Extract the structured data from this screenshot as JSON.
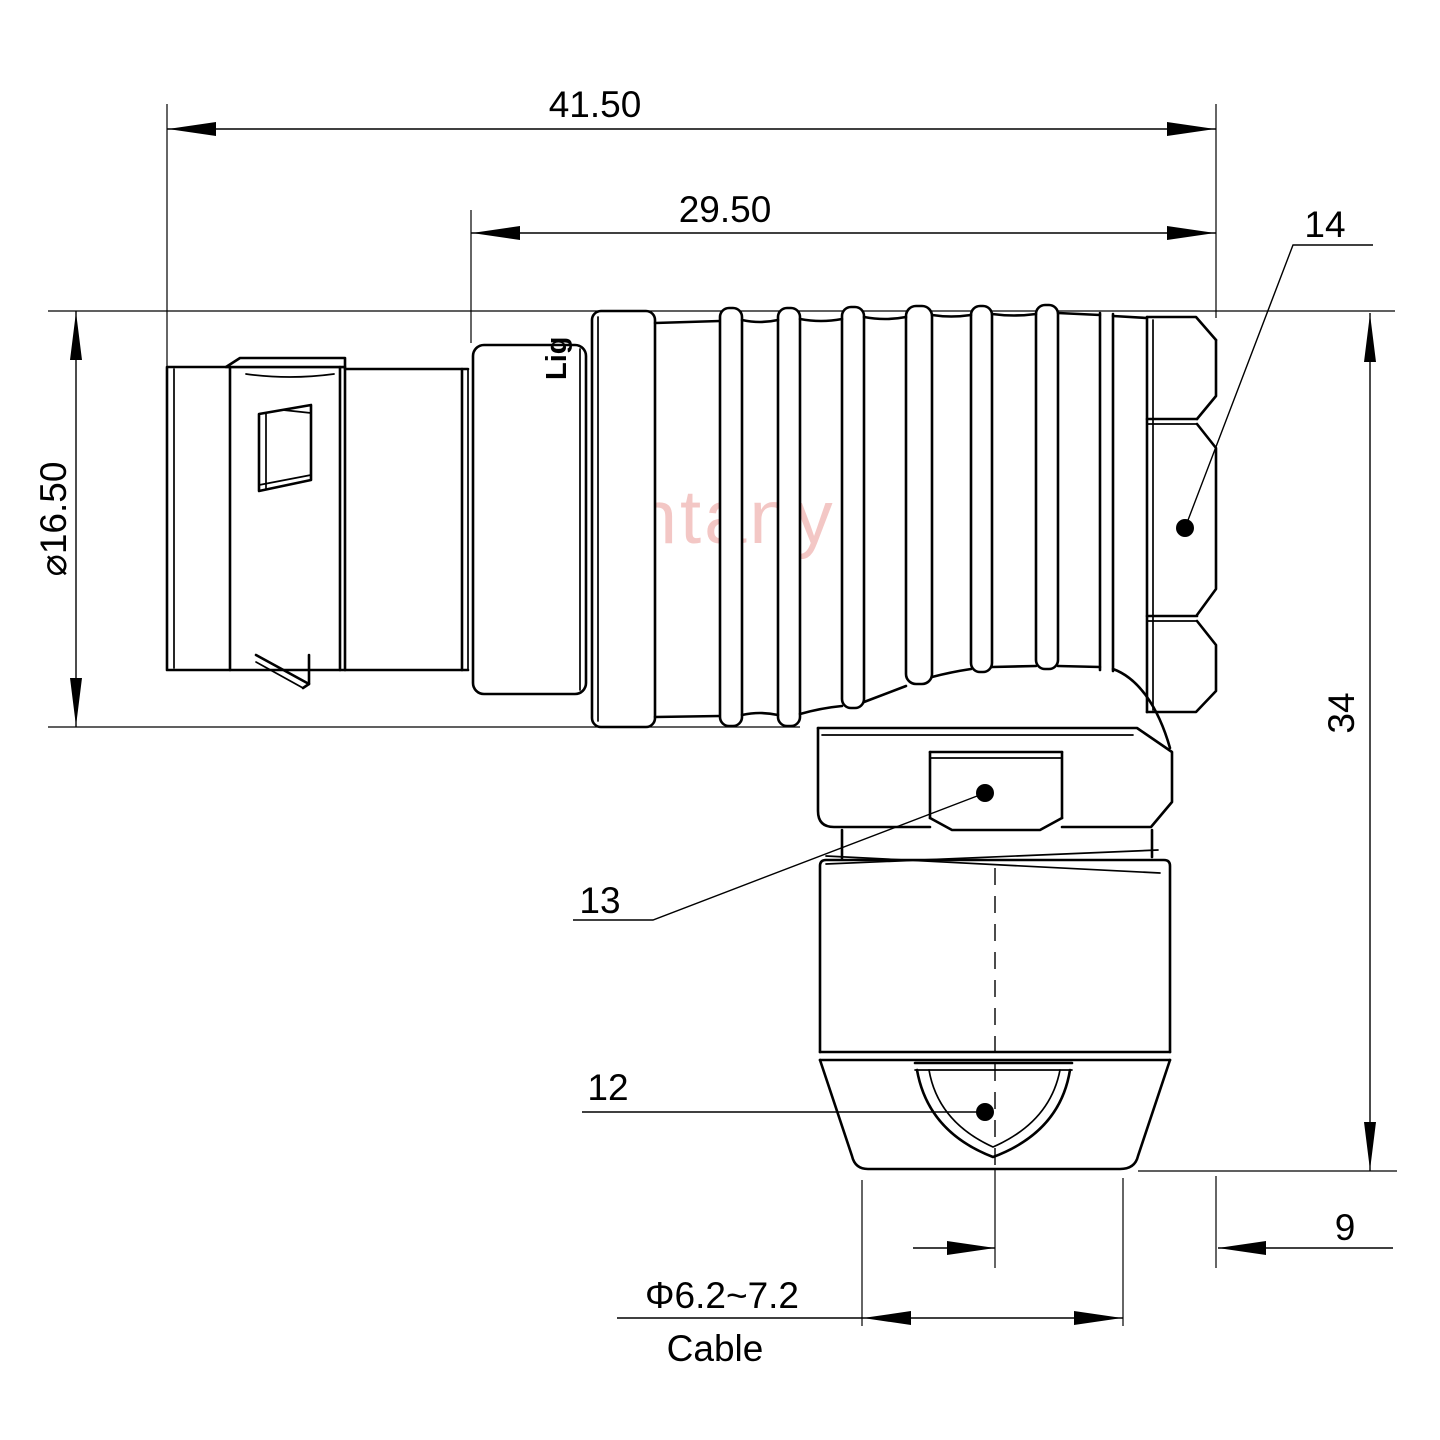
{
  "drawing": {
    "type": "technical-dimension-drawing",
    "dimensions": {
      "overall_length": "41.50",
      "front_length": "29.50",
      "outer_diameter": "⌀16.50",
      "total_height": "34",
      "side_offset": "9",
      "cable_diameter": "Φ6.2~7.2",
      "cable_label": "Cable"
    },
    "callouts": {
      "strain_relief_cone": "12",
      "clamp_backnut": "13",
      "hex_coupling_nut": "14"
    },
    "watermark": "Lightany",
    "part_engraving": "Lig",
    "colors": {
      "line": "#000000",
      "watermark": "#e9908c",
      "background": "#ffffff"
    }
  }
}
